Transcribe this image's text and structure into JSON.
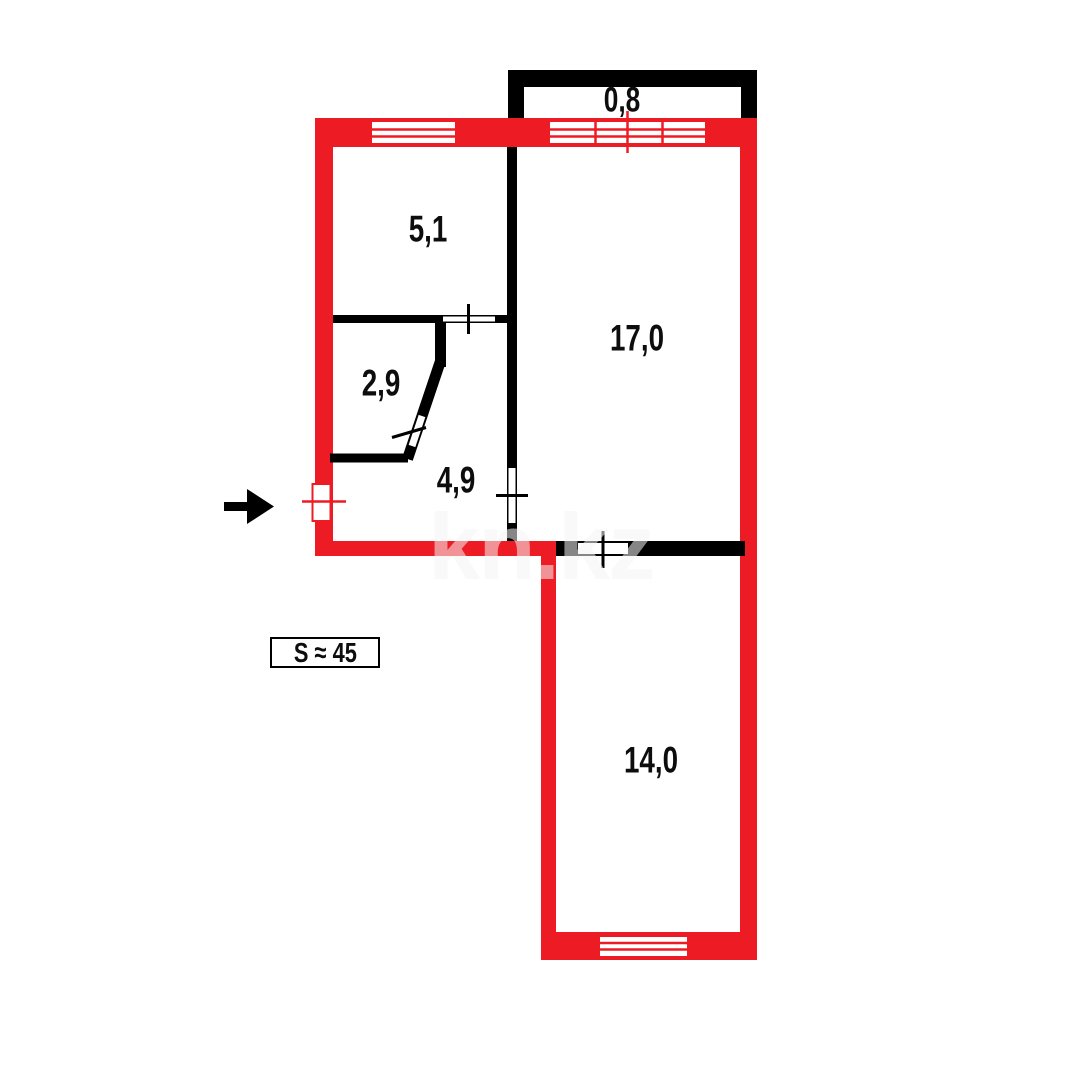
{
  "colors": {
    "wall_red": "#ED1C24",
    "wall_black": "#000000",
    "label_text": "#0d0d0d",
    "watermark_text": "rgba(244,244,244,0.55)"
  },
  "rooms": [
    {
      "id": "balcony",
      "label": "0,8"
    },
    {
      "id": "room-5-1",
      "label": "5,1"
    },
    {
      "id": "room-2-9",
      "label": "2,9"
    },
    {
      "id": "hallway-4-9",
      "label": "4,9"
    },
    {
      "id": "room-17-0",
      "label": "17,0"
    },
    {
      "id": "room-14-0",
      "label": "14,0"
    }
  ],
  "summary": {
    "total_area": "S ≈ 45"
  },
  "watermark": {
    "text": "kn.kz"
  }
}
